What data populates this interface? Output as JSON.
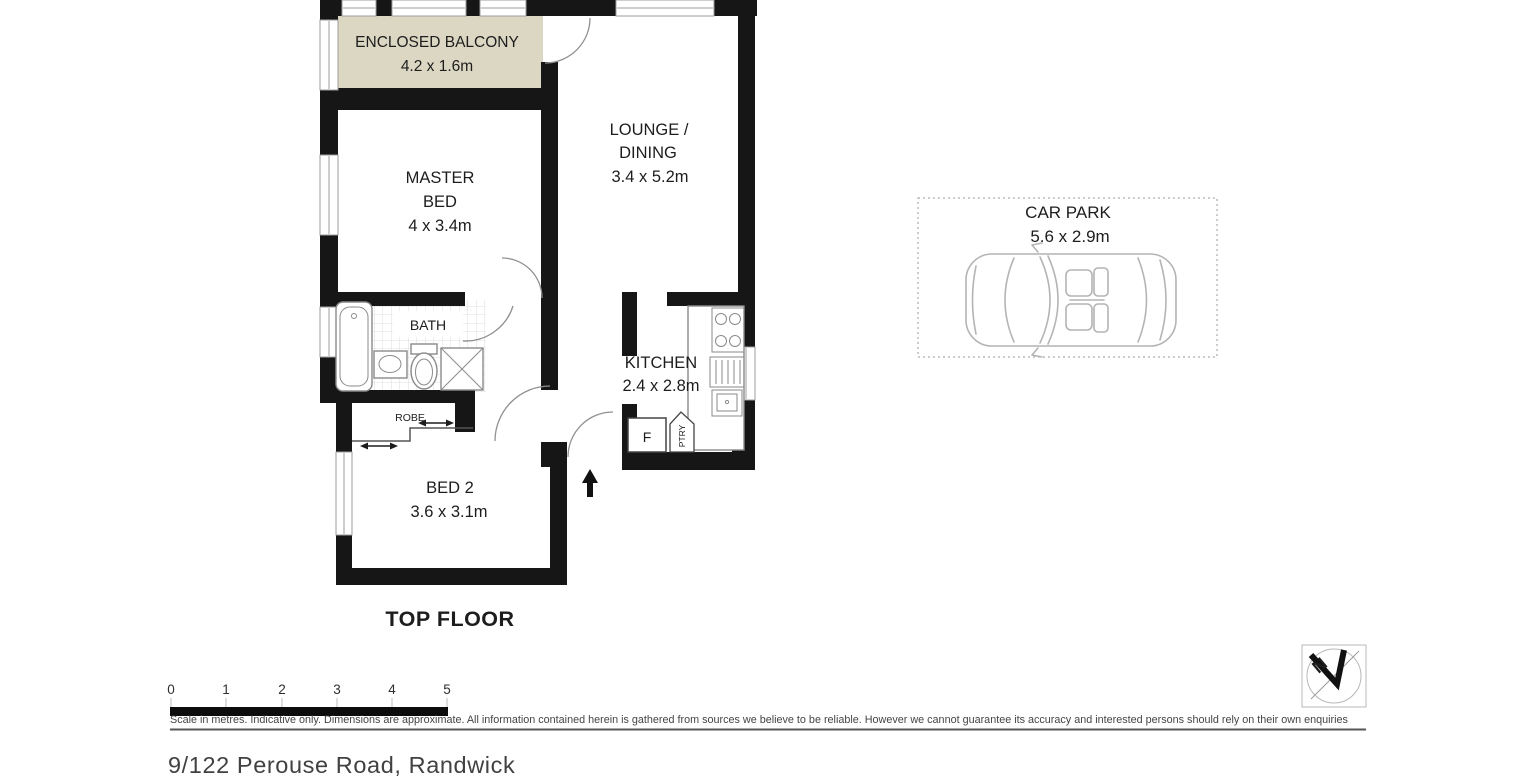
{
  "page": {
    "background": "#ffffff"
  },
  "floor_plan": {
    "level_label": "TOP FLOOR",
    "wall_color": "#161616",
    "rooms": {
      "balcony": {
        "name": "ENCLOSED BALCONY",
        "dims": "4.2 x 1.6m",
        "fill": "#dbd7c3"
      },
      "master_bed": {
        "line1": "MASTER",
        "line2": "BED",
        "dims": "4 x 3.4m"
      },
      "lounge_dining": {
        "line1": "LOUNGE /",
        "line2": "DINING",
        "dims": "3.4 x 5.2m"
      },
      "bath": {
        "name": "BATH"
      },
      "kitchen": {
        "name": "KITCHEN",
        "dims": "2.4 x 2.8m"
      },
      "robe": {
        "name": "ROBE"
      },
      "bed2": {
        "name": "BED 2",
        "dims": "3.6 x 3.1m"
      },
      "fridge_label": "F",
      "pantry_label": "PTRY"
    }
  },
  "car_park": {
    "name": "CAR PARK",
    "dims": "5.6 x 2.9m"
  },
  "scale_bar": {
    "ticks": [
      "0",
      "1",
      "2",
      "3",
      "4",
      "5"
    ]
  },
  "disclaimer": "Scale in metres. Indicative only. Dimensions are approximate. All information contained herein is gathered from sources we believe to be reliable. However we cannot guarantee its accuracy and interested persons should rely on their own enquiries",
  "address": "9/122 Perouse Road, Randwick",
  "compass": {
    "north_label": "N"
  }
}
